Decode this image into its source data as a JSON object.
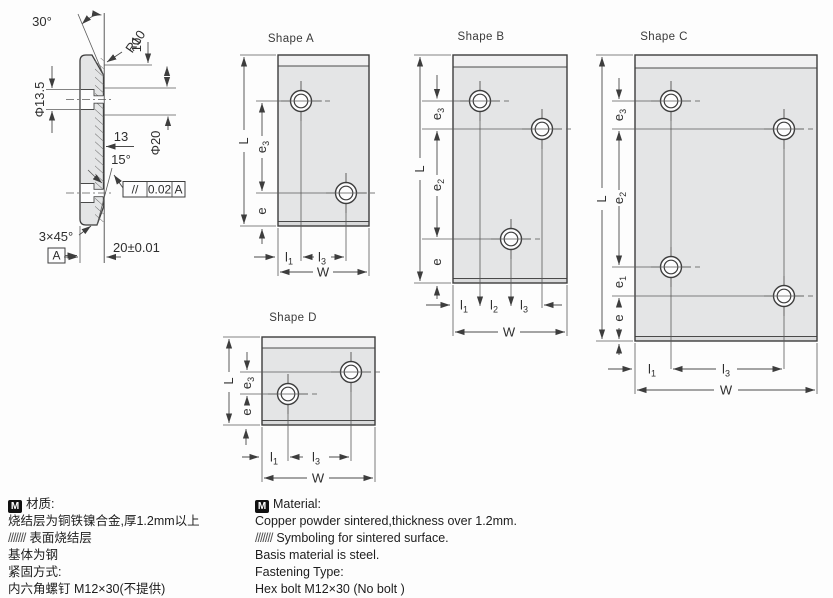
{
  "dims": {
    "L": "L",
    "W": "W",
    "e": "e",
    "l": "l",
    "sub1": "1",
    "sub2": "2",
    "sub3": "3"
  },
  "section": {
    "angle30": "30°",
    "r10": "R10",
    "d10": "10",
    "dia135": "Φ13.5",
    "dia20": "Φ20",
    "depth13": "13",
    "angle15": "15°",
    "tol_sym": "//",
    "tol_val": "0.02",
    "tol_datum": "A",
    "chamfer": "3×45°",
    "datum": "A",
    "thickness": "20±0.01"
  },
  "shapes": {
    "a": {
      "title": "Shape A"
    },
    "b": {
      "title": "Shape B"
    },
    "c": {
      "title": "Shape C"
    },
    "d": {
      "title": "Shape D"
    }
  },
  "notes": {
    "cn": {
      "m": "M",
      "title": "材质:",
      "line2": "烧结层为铜铁镍合金,厚1.2mm以上",
      "hatch": "///////",
      "line3": "表面烧结层",
      "line4": "基体为钢",
      "line5": "紧固方式:",
      "line6": "内六角螺钉 M12×30(不提供)"
    },
    "en": {
      "m": "M",
      "title": "Material:",
      "line2": "Copper powder sintered,thickness over 1.2mm.",
      "hatch": "///////",
      "line3": "Symboling for sintered surface.",
      "line4": "Basis material is steel.",
      "line5": "Fastening Type:",
      "line6": "Hex bolt M12×30 (No bolt )"
    }
  },
  "colors": {
    "plate": "#e4e5e6",
    "band": "#f0f0f1",
    "strip": "#d9dadb",
    "line": "#3d3d3d"
  }
}
